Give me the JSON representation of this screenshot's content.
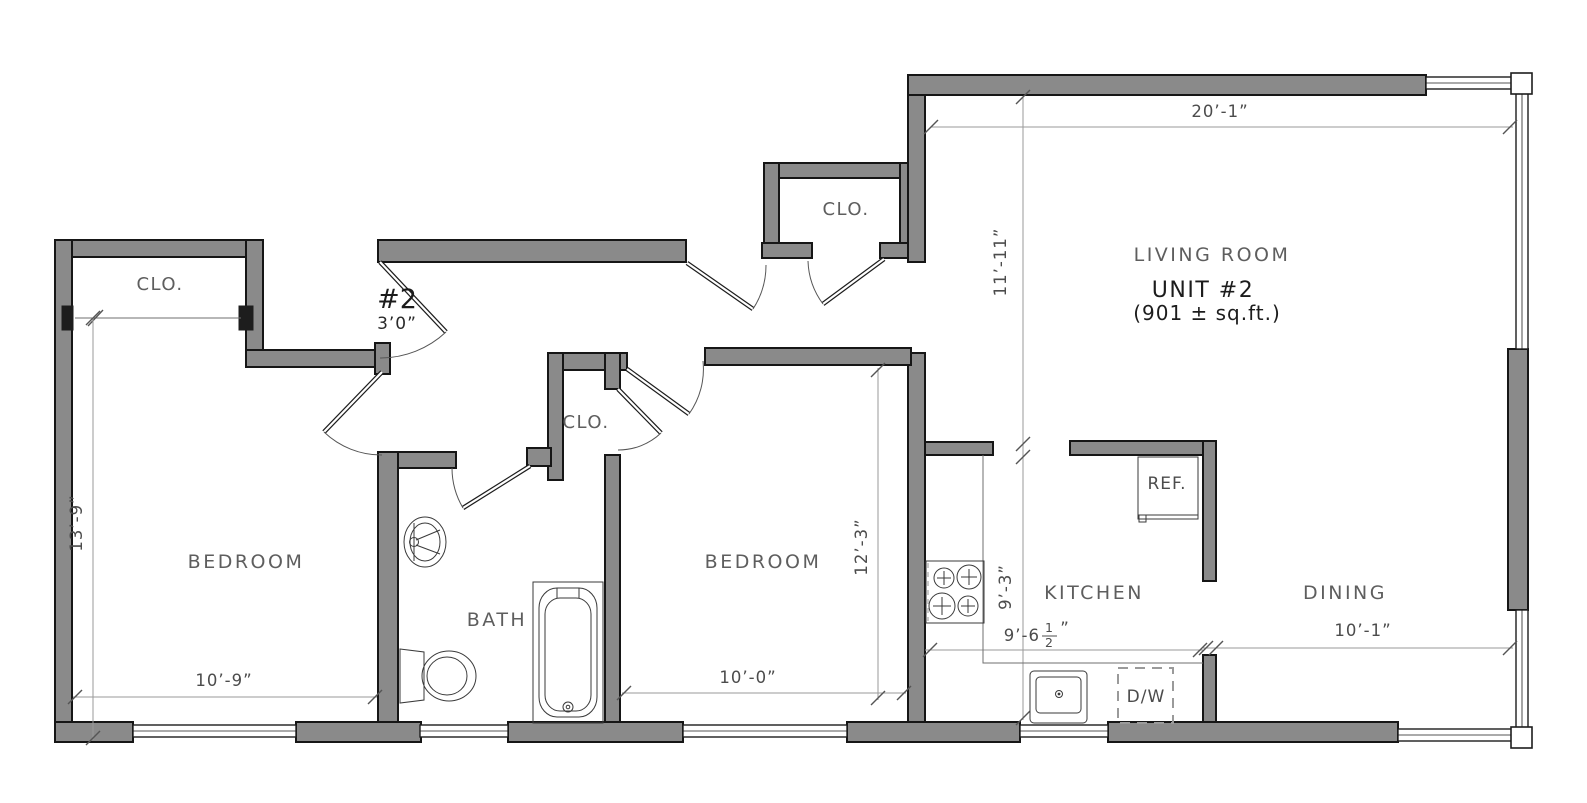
{
  "drawing": {
    "living_room_label": "LIVING ROOM",
    "unit_label": "UNIT #2",
    "area_label": "(901 ± sq.ft.)"
  },
  "rooms": {
    "closet_entry": "CLO.",
    "closet_hall": "CLO.",
    "closet_bedroom": "CLO.",
    "bedroom_left": "BEDROOM",
    "bedroom_middle": "BEDROOM",
    "bath": "BATH",
    "kitchen": "KITCHEN",
    "dining": "DINING"
  },
  "appliances": {
    "refrigerator": "REF.",
    "dishwasher": "D/W"
  },
  "entry_door": {
    "number": "#2",
    "width": "3’0”"
  },
  "dimensions": {
    "living_room_width": "20’-1”",
    "living_room_depth": "11’-11”",
    "bedroom_left_depth": "13’-9”",
    "bedroom_left_width": "10’-9”",
    "bedroom_middle_depth": "12’-3”",
    "bedroom_middle_width": "10’-0”",
    "kitchen_depth": "9’-3”",
    "kitchen_width_whole": "9’-6",
    "kitchen_width_numerator": "1",
    "kitchen_width_denominator": "2",
    "kitchen_width_suffix": "”",
    "dining_width": "10’-1”"
  },
  "colors": {
    "wall_fill": "#8a8a8a",
    "wall_stroke": "#161616",
    "dimension_line": "#9a9a9a",
    "room_label": "#5e5e5e",
    "dimension_label": "#4c4c4c",
    "unit_label": "#1c1c1c",
    "background": "#ffffff"
  }
}
